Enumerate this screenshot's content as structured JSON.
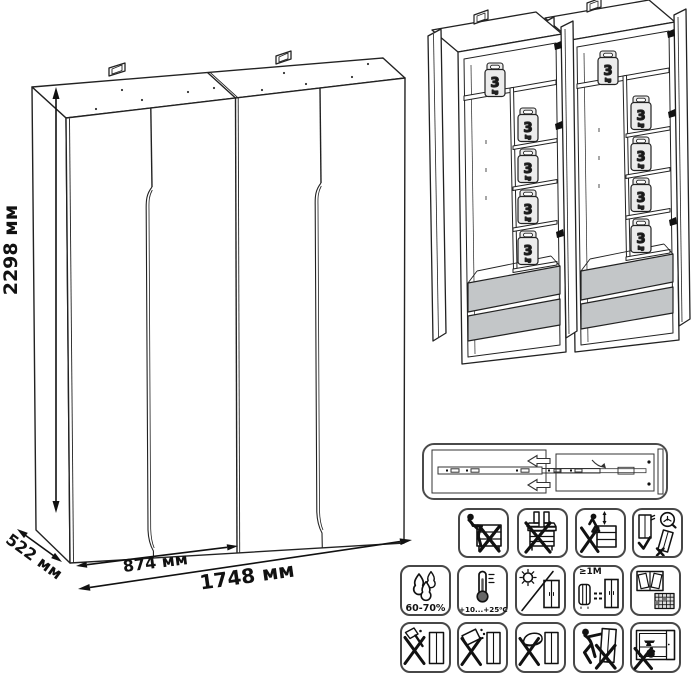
{
  "main_view": {
    "height_label": "2298 мм",
    "depth_label": "522 мм",
    "module_width_label": "874 мм",
    "total_width_label": "1748 мм"
  },
  "open_view": {
    "shelf_load_value": "3",
    "shelf_load_unit": "kg"
  },
  "info_panel": {
    "humidity_label": "60-70%",
    "temperature_label": "+10...+25⁰C",
    "heat_distance_label": "≥1М",
    "icons_row1": [
      "no-sitting",
      "no-standing",
      "no-climbing",
      "secure-to-wall"
    ],
    "icons_row2": [
      "humidity-range",
      "temperature-range",
      "no-direct-sunlight",
      "keep-distance-from-heat",
      "ventilate-room"
    ],
    "icons_row3": [
      "no-solvents",
      "no-liquids",
      "no-abrasives",
      "no-dragging",
      "no-heavy-load"
    ]
  },
  "colors": {
    "line": "#1d1d1d",
    "drawer_fill": "#c3c6c8",
    "weight_fill": "#ececec"
  }
}
